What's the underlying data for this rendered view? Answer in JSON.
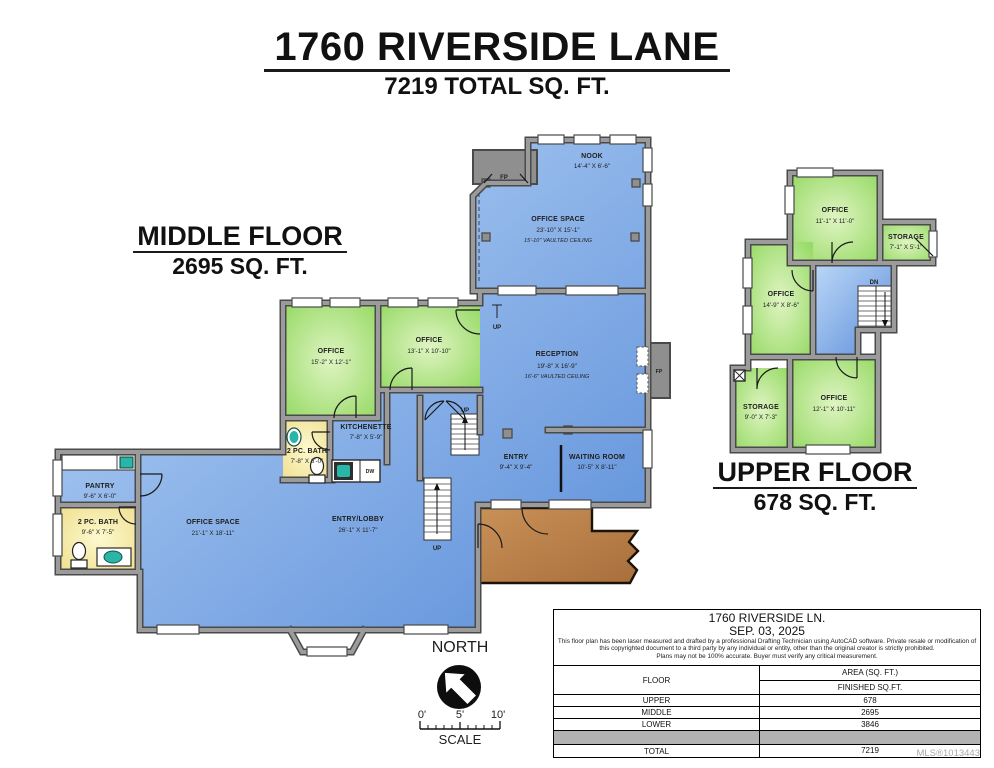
{
  "page": {
    "title": "1760 RIVERSIDE LANE",
    "subtitle": "7219 TOTAL SQ. FT."
  },
  "middle_floor": {
    "heading": "MIDDLE FLOOR",
    "area": "2695 SQ. FT.",
    "rooms": {
      "nook": {
        "name": "NOOK",
        "dims": "14'-4\" X 6'-6\""
      },
      "office_space_top": {
        "name": "OFFICE SPACE",
        "dims": "23'-10\" X 15'-1\"",
        "note": "15'-10\" VAULTED CEILING"
      },
      "office_1": {
        "name": "OFFICE",
        "dims": "15'-2\" X 12'-1\""
      },
      "office_2": {
        "name": "OFFICE",
        "dims": "13'-1\" X 10'-10\""
      },
      "reception": {
        "name": "RECEPTION",
        "dims": "19'-8\" X 16'-9\"",
        "note": "16'-6\" VAULTED CEILING"
      },
      "kitchenette": {
        "name": "KITCHENETTE",
        "dims": "7'-8\" X 5'-9\""
      },
      "bath_mid": {
        "name": "2 PC. BATH",
        "dims": "7'-8\" X 6'-0\""
      },
      "pantry": {
        "name": "PANTRY",
        "dims": "9'-6\" X 6'-0\""
      },
      "bath_left": {
        "name": "2 PC. BATH",
        "dims": "9'-6\" X 7'-5\""
      },
      "office_space_main": {
        "name": "OFFICE SPACE",
        "dims": "21'-1\" X 18'-11\""
      },
      "entry_lobby": {
        "name": "ENTRY/LOBBY",
        "dims": "26'-1\" X 11'-7\""
      },
      "entry": {
        "name": "ENTRY",
        "dims": "9'-4\" X 9'-4\""
      },
      "waiting_room": {
        "name": "WAITING ROOM",
        "dims": "10'-5\" X 8'-11\""
      }
    },
    "annotations": {
      "fp_top": "FP",
      "fp_right": "FP",
      "up_step": "UP",
      "up_stair_small": "UP",
      "up_stair_long": "UP",
      "dw": "DW"
    }
  },
  "upper_floor": {
    "heading": "UPPER FLOOR",
    "area": "678 SQ. FT.",
    "rooms": {
      "office_top": {
        "name": "OFFICE",
        "dims": "11'-1\" X 11'-0\""
      },
      "storage_right": {
        "name": "STORAGE",
        "dims": "7'-1\" X 5'-1\""
      },
      "office_left": {
        "name": "OFFICE",
        "dims": "14'-9\" X 8'-6\""
      },
      "storage_bottom": {
        "name": "STORAGE",
        "dims": "9'-0\" X 7'-3\""
      },
      "office_bottom": {
        "name": "OFFICE",
        "dims": "12'-1\" X 10'-11\""
      }
    },
    "annotations": {
      "dn": "DN"
    }
  },
  "compass": {
    "label": "NORTH"
  },
  "scale_bar": {
    "tick0": "0'",
    "tick5": "5'",
    "tick10": "10'",
    "label": "SCALE"
  },
  "info_table": {
    "title": "1760 RIVERSIDE LN.",
    "date": "SEP. 03, 2025",
    "disclaimer": [
      "This floor plan has been laser measured and drafted by a professional Drafting Technician using AutoCAD software. Private resale or modification of",
      "this copyrighted document to a third party by any individual or entity, other than the original creator is strictly prohibited.",
      "Plans may not be 100% accurate.  Buyer must verify any critical measurement."
    ],
    "col_floor": "FLOOR",
    "col_area": "AREA (SQ. FT.)",
    "col_finished": "FINISHED SQ.FT.",
    "rows": [
      {
        "floor": "UPPER",
        "area": "678"
      },
      {
        "floor": "MIDDLE",
        "area": "2695"
      },
      {
        "floor": "LOWER",
        "area": "3846"
      }
    ],
    "total_label": "TOTAL",
    "total_value": "7219"
  },
  "watermark": "MLS®1013443",
  "colors": {
    "room_blue": "#6d9de2",
    "room_green": "#9ddb68",
    "room_yellow": "#f5ec9f",
    "deck_brown": "#bc8450",
    "wall_gray": "#9b9b9b",
    "wall_dark": "#4a4a4a",
    "fixture_teal": "#27b6a8"
  }
}
